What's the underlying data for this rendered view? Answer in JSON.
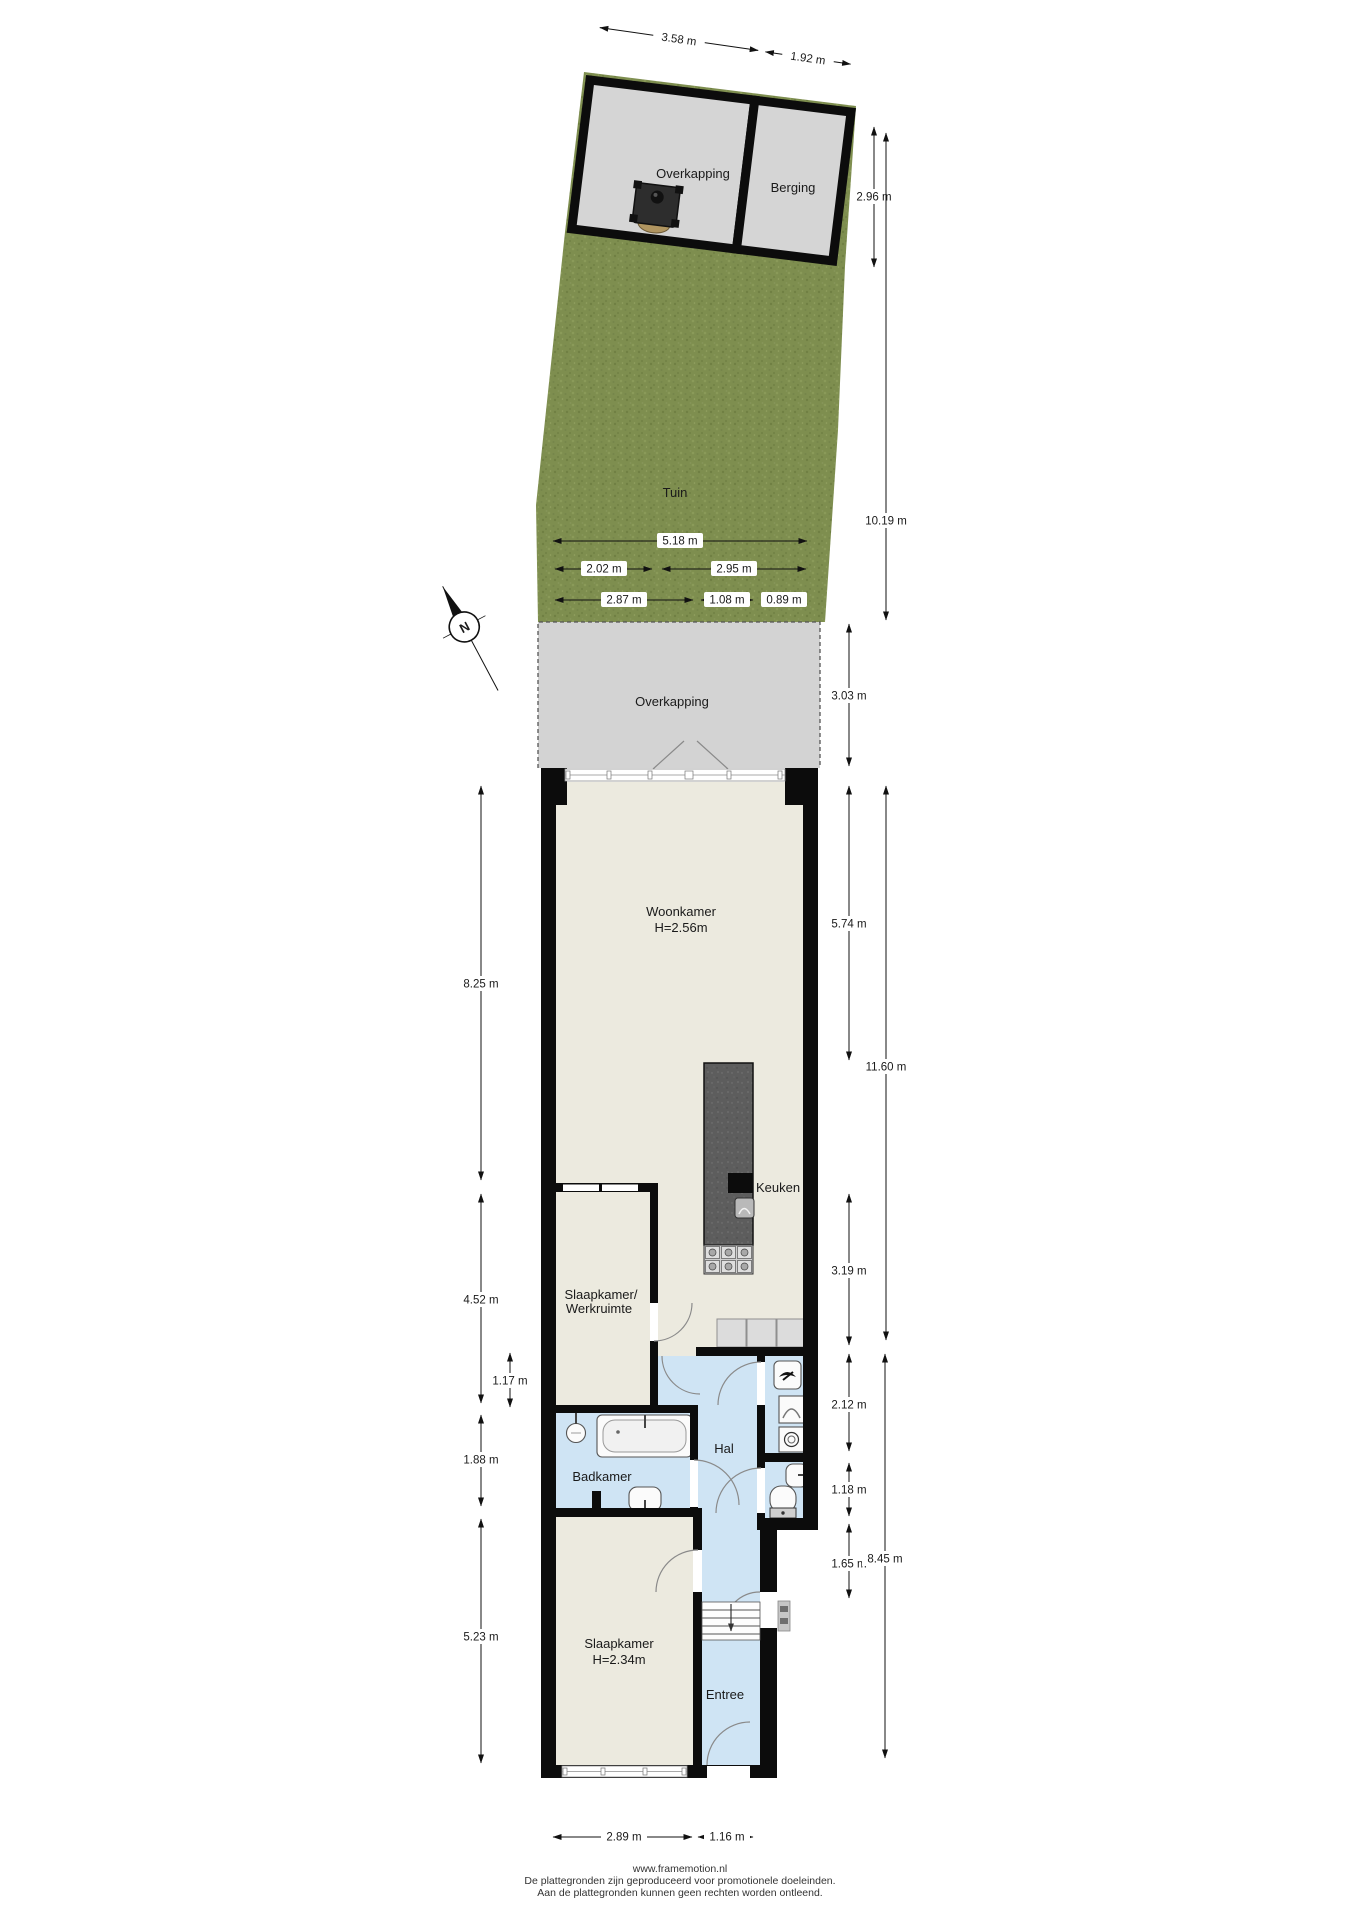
{
  "site": {
    "garden_label": "Tuin",
    "carport_top_label": "Overkapping",
    "shed_label": "Berging",
    "carport_lower_label": "Overkapping"
  },
  "rooms": {
    "living": {
      "name": "Woonkamer",
      "ceiling": "H=2.56m"
    },
    "kitchen": {
      "name": "Keuken"
    },
    "bedroom_office": {
      "line1": "Slaapkamer/",
      "line2": "Werkruimte"
    },
    "bathroom": {
      "name": "Badkamer"
    },
    "hall": {
      "name": "Hal"
    },
    "bedroom": {
      "name": "Slaapkamer",
      "ceiling": "H=2.34m"
    },
    "entry": {
      "name": "Entree"
    }
  },
  "compass": {
    "north_label": "N"
  },
  "dimensions": {
    "carport_top_width": "3.58 m",
    "shed_width": "1.92 m",
    "shed_depth": "2.96 m",
    "garden_length": "10.19 m",
    "garden_width_total": "5.18 m",
    "garden_width_left": "2.02 m",
    "garden_width_right": "2.95 m",
    "garden_lower_left": "2.87 m",
    "garden_lower_mid": "1.08 m",
    "garden_lower_right": "0.89 m",
    "carport_lower_depth": "3.03 m",
    "living_length_left": "8.25 m",
    "living_length_right": "5.74 m",
    "house_upper_length": "11.60 m",
    "office_length": "4.52 m",
    "office_nook": "1.17 m",
    "kitchen_side": "3.19 m",
    "utility_side": "2.12 m",
    "bath_length": "1.88 m",
    "wc_side": "1.18 m",
    "stairs_side": "1.65 m",
    "house_lower_length": "8.45 m",
    "bedroom_length": "5.23 m",
    "bedroom_width": "2.89 m",
    "entry_width": "1.16 m"
  },
  "footer": {
    "url": "www.framemotion.nl",
    "disclaimer1": "De plattegronden zijn geproduceerd voor promotionele doeleinden.",
    "disclaimer2": "Aan de plattegronden kunnen geen rechten worden ontleend."
  },
  "colors": {
    "floor_cream": "#eceadf",
    "floor_blue": "#cfe4f4",
    "floor_gray": "#d3d3d3",
    "grass_green": "#7e8e4f",
    "wall_black": "#0c0c0c"
  }
}
